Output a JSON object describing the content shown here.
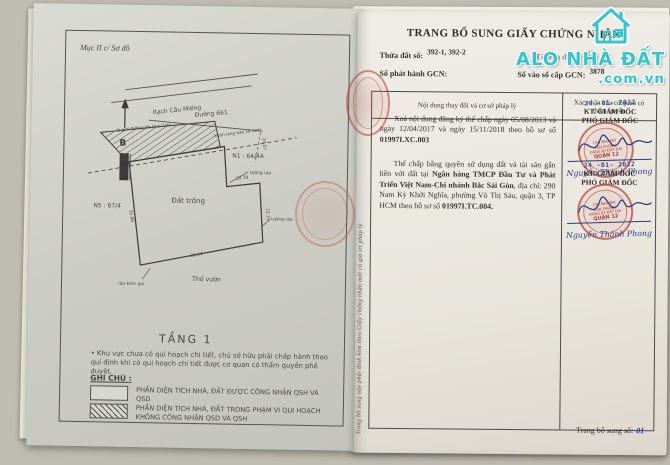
{
  "watermark": {
    "brand": "ALO NHÀ ĐẤT",
    "domain": ".com.vn"
  },
  "left_page": {
    "section_label": "Mục II c/ Sơ đồ",
    "map": {
      "north_label": "B",
      "canal_label": "Rạch Cầu Miếng",
      "road_label": "Đường 661",
      "road_edge_label": "lộ giới đường Hà Huy Giáp",
      "corridor_label": "hành lang bảo vệ rạch",
      "parcel_label": "Đất trống",
      "neighbor_right_label": "N1 : 64/4A",
      "neighbor_left_label": "N5 : 67/4",
      "garden_label": "Thổ vườn",
      "fence_label": "tường rào",
      "fence_label_2": "tường rào",
      "barbed_wire_label": "rào kẽm gai",
      "dim_bottom": "21.64",
      "dim_right": "12.19",
      "dim_step": "10.78",
      "dim_left": "35.86",
      "dim_road": "20.07"
    },
    "floor_label": "TẦNG 1",
    "planning_note": "Khu vực chưa có qui hoạch chi tiết, chủ sở hữu phải chấp hành theo qui định khi có qui hoạch chi tiết được cơ quan có thẩm quyền phê duyệt.",
    "legend_title": "GHI CHÚ :",
    "legend_item_1": "PHẦN DIỆN TÍCH NHÀ, ĐẤT ĐƯỢC CÔNG NHẬN QSH VÀ QSD",
    "legend_item_2": "PHẦN DIỆN TÍCH NHÀ, ĐẤT TRONG PHẠM VI QUI HOẠCH KHÔNG CÔNG NHẬN QSD VÀ QSH"
  },
  "right_page": {
    "title": "TRANG BỔ SUNG GIẤY CHỨNG NHẬN",
    "fields": {
      "parcel_label": "Thửa đất số:",
      "parcel_value": "392-1, 392-2",
      "map_sheet_label": "Tờ bản đồ số:",
      "map_sheet_value": "23",
      "gcn_issue_label": "Số phát hành GCN:",
      "gcn_book_label": "Số vào sổ cấp GCN:",
      "gcn_book_value": "3878"
    },
    "table": {
      "col_content": "Nội dung thay đổi và cơ sở pháp lý",
      "col_confirm": "Xác nhận của cơ quan có thẩm quyền"
    },
    "entry_1": {
      "text": "Xoá nội dung đăng ký thế chấp ngày 05/08/2013 và ngày 12/04/2017 và ngày 15/11/2018 theo hồ sơ số ",
      "ref": "01997I.XC.003"
    },
    "entry_2": {
      "text_1": "Thế chấp bằng quyền sử dụng đất và tài sản gắn liền với đất tại ",
      "bank": "Ngân hàng TMCP Đầu Tư và Phát Triển Việt Nam-Chi nhánh Bắc Sài Gòn",
      "text_2": ", địa chỉ: 290 Nam Kỳ Khởi Nghĩa, phường Võ Thị Sáu, quận 3, TP HCM theo hồ sơ số ",
      "ref": "01997I.TC.004."
    },
    "stamp": {
      "date": "24 -01- 2022",
      "title_1": "KT. GIÁM ĐỐC",
      "title_2": "PHÓ GIÁM ĐỐC",
      "seal_line_1": "CHI NHÁNH",
      "seal_line_2": "VĂN PHÒNG",
      "seal_line_3": "ĐĂNG KÝ ĐẤT ĐAI",
      "seal_line_4": "QUẬN 12",
      "signer": "Nguyễn Thành Phong"
    },
    "side_note": "Trang bổ sung này phải đính kèm theo Giấy chứng nhận mới có giá trị pháp lý",
    "footer_label": "Trang bổ sung số:",
    "footer_value": "01"
  }
}
